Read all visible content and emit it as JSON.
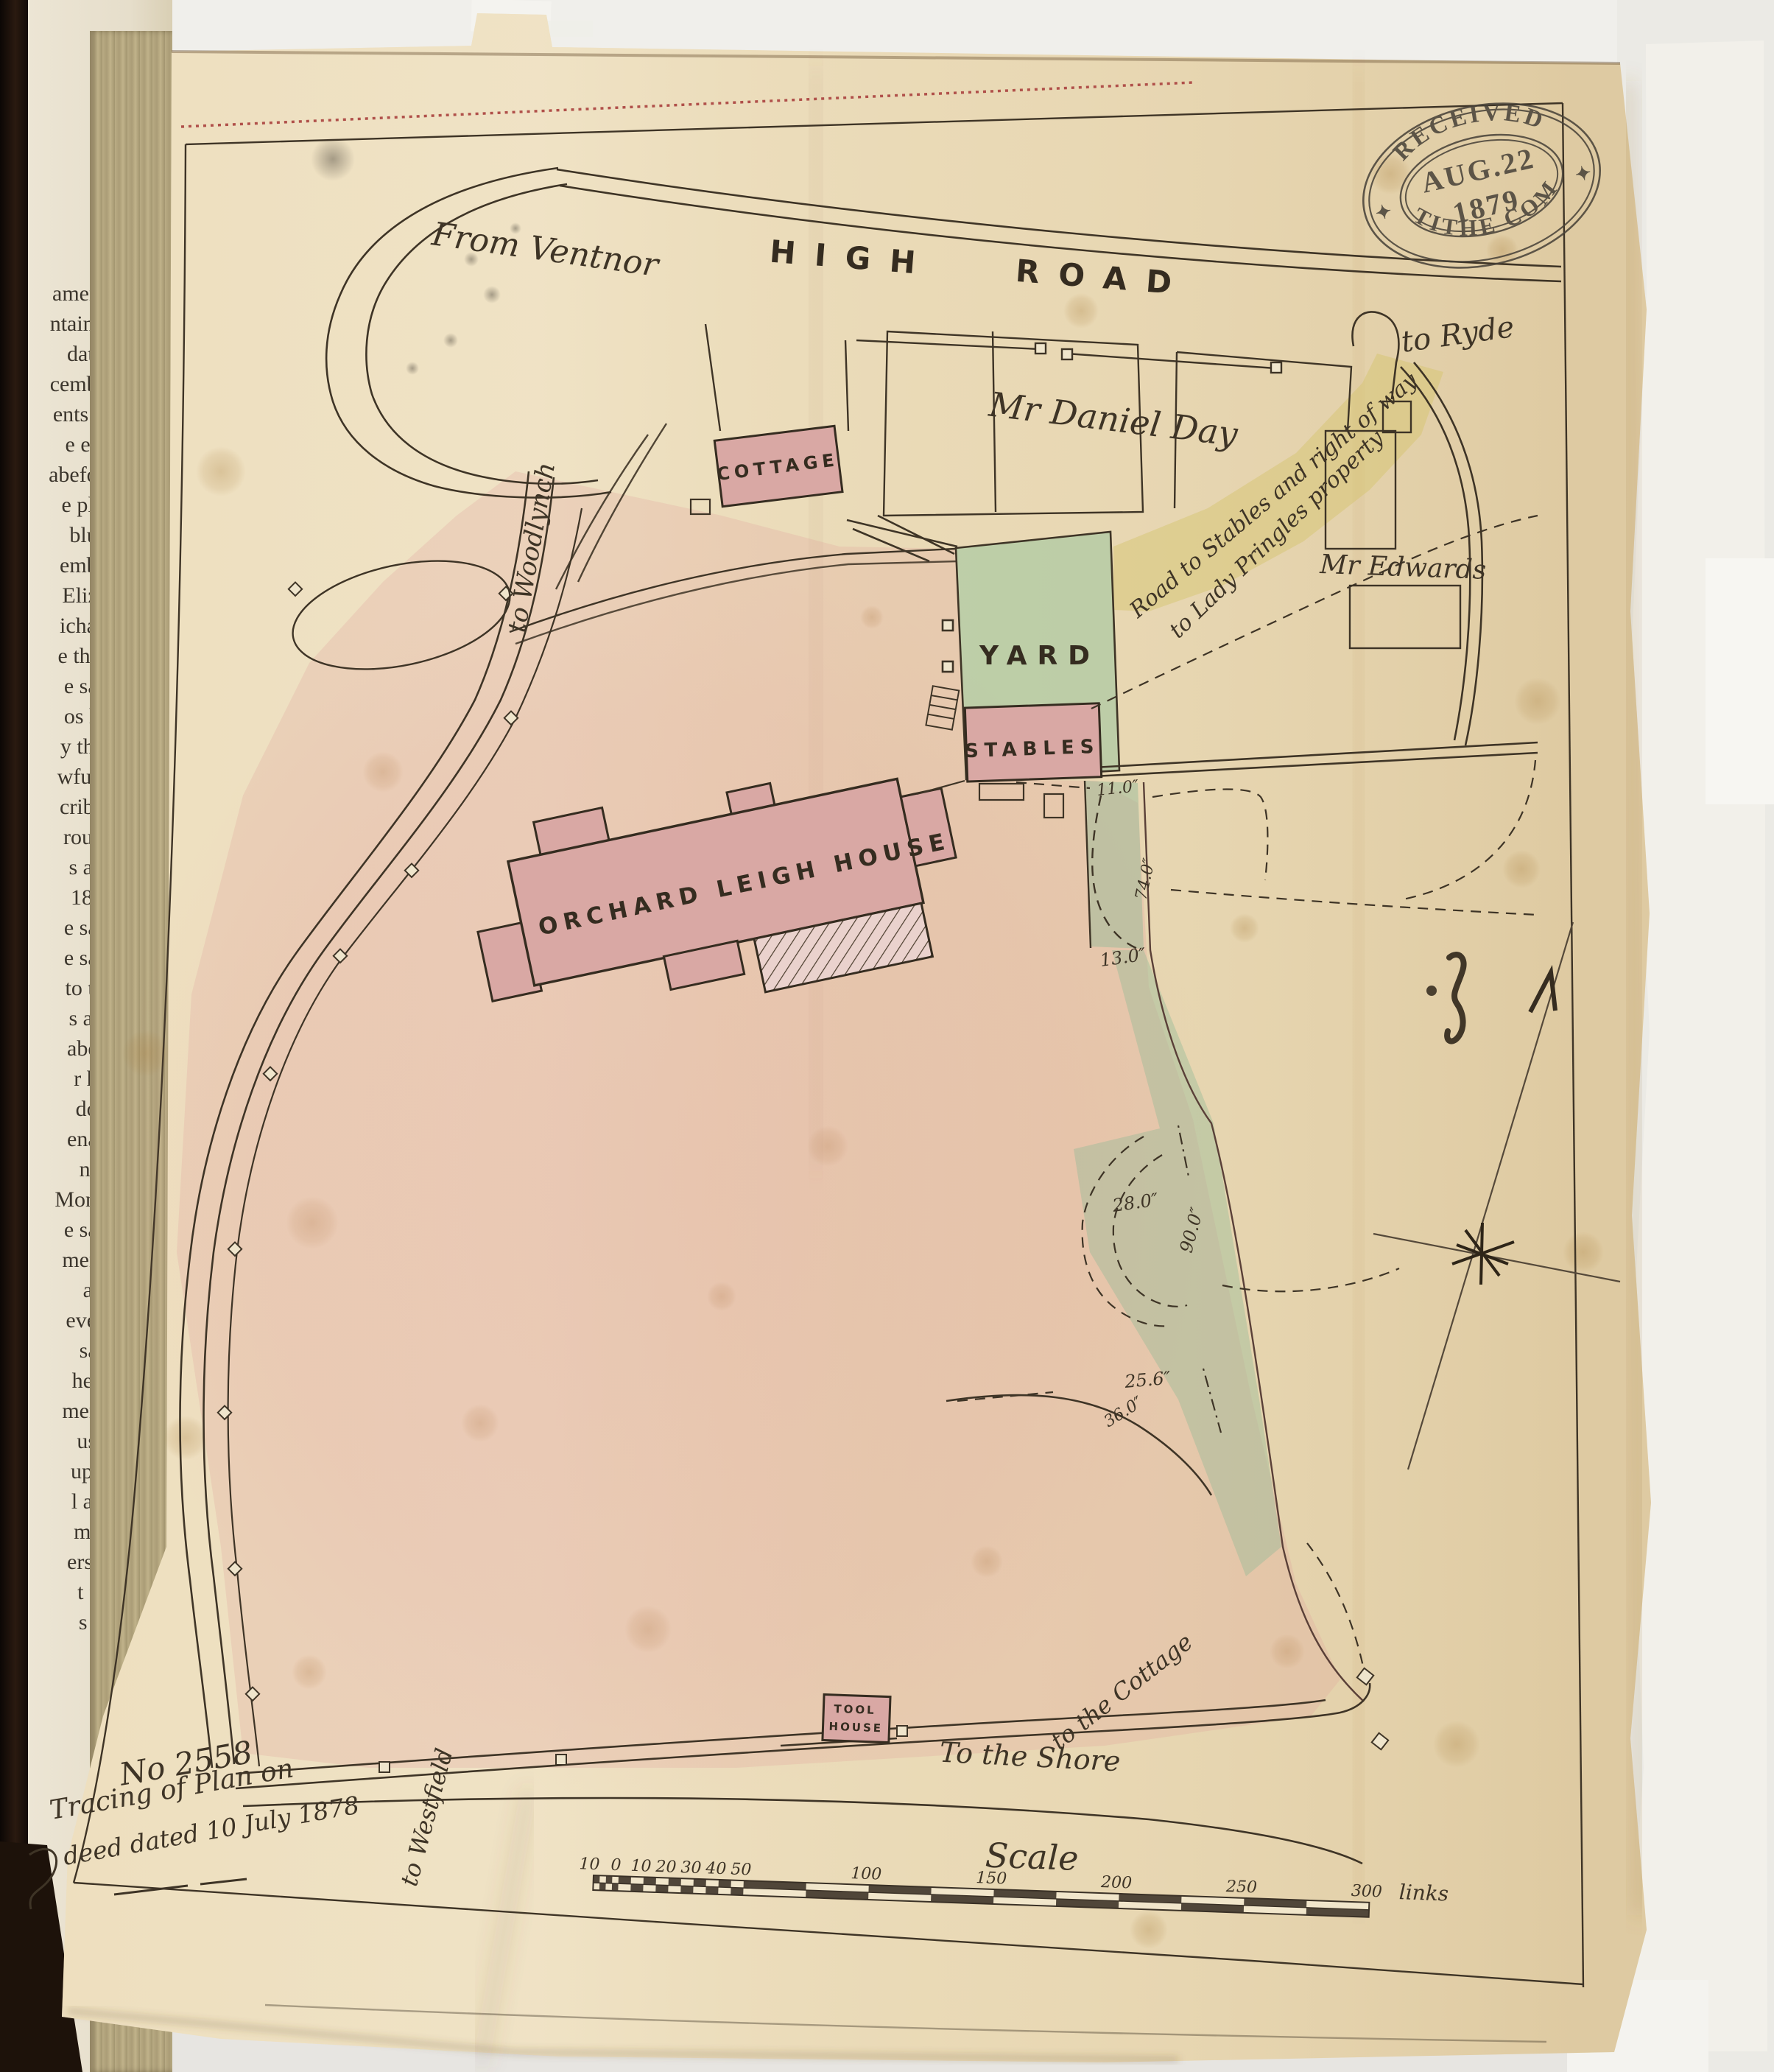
{
  "page": {
    "book_margin_lines": [
      "aments",
      "ntained",
      "dated",
      "cember",
      "ents an",
      "e east",
      "abefore",
      "e plan",
      "blue)",
      "ember",
      "Eliza-",
      "ichard",
      "e third",
      "e said",
      "os his",
      "y then",
      "wfully",
      "cribed",
      "rough",
      "s and",
      "1864",
      "e said",
      "e said",
      "to the",
      "s and",
      "abeth",
      "r her",
      "doth",
      "enant",
      "not-",
      "Monro",
      "e said",
      "ments",
      "and",
      "every",
      "said",
      "heirs",
      "ments",
      "uses",
      "upon",
      "l and",
      "m or",
      "erson",
      "t for",
      "s by"
    ]
  },
  "stamp": {
    "arc_top": "RECEIVED",
    "line1": "AUG.22",
    "line2": "1879",
    "arc_bottom": "TITHE COM",
    "star": "✦"
  },
  "labels": {
    "from_ventnor": "From Ventnor",
    "high_road": "HIGH ROAD",
    "to_ryde": "to Ryde",
    "daniel_day": "Mr Daniel Day",
    "edwards": "Mr Edwards",
    "to_woodlynch": "to Woodlynch",
    "cottage": "COTTAGE",
    "yard": "YARD",
    "stables": "STABLES",
    "road_to_stables_1": "Road to Stables and right of way",
    "road_to_stables_2": "to Lady Pringles property",
    "house": "ORCHARD LEIGH HOUSE",
    "tool_1": "TOOL",
    "tool_2": "HOUSE",
    "to_the_shore": "To the Shore",
    "to_the_cottage": "to the Cottage",
    "to_westfield": "to Westfield"
  },
  "measurements": {
    "m1": "11.0″",
    "m2": "74.0″",
    "m3": "13.0″",
    "m4": "28.0″",
    "m5": "90.0″",
    "m6": "25.6″",
    "m7": "36.0″"
  },
  "footer": {
    "number": "No 2558",
    "line1": "Tracing of Plan on",
    "line2": "deed dated 10 July 1878"
  },
  "scale": {
    "title": "Scale",
    "ticks": [
      "10",
      "0",
      "10",
      "20",
      "30",
      "40",
      "50",
      "100",
      "150",
      "200",
      "250",
      "300"
    ],
    "unit": "links"
  },
  "colors": {
    "paper": "#e9d9b6",
    "pink_wash": "#dd9494",
    "building_pink": "#d9a8a4",
    "green": "#96c19b",
    "yellow": "#d6c46e",
    "ink": "#3e3426",
    "stamp_ink": "#474138",
    "stitch": "#b0504a"
  }
}
